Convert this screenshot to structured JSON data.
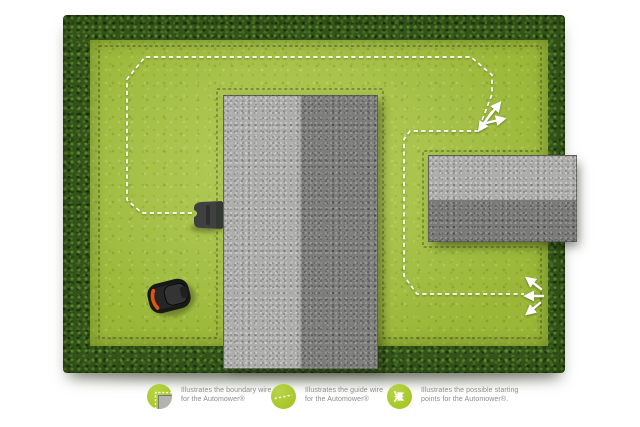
{
  "colors": {
    "background": "#ffffff",
    "grass_green": "#a5c240",
    "hedge_green": "#33531a",
    "legend_green": "#a4c422",
    "legend_text": "#8c8c8c",
    "building_gray": "#9c9c9a",
    "boundary_line": "#2e3524",
    "guide_line": "#ffffff",
    "charging_station": "#3f4140",
    "mower_body": "#181818",
    "mower_accent": "#e2560c"
  },
  "legend": {
    "items": [
      {
        "icon": "boundary-wire-icon",
        "line1": "Illustrates the boundary wire",
        "line2": "for the Automower®"
      },
      {
        "icon": "guide-wire-icon",
        "line1": "Illustrates the guide wire",
        "line2": "for the Automower®"
      },
      {
        "icon": "starting-points-icon",
        "line1": "Illustrates the possible starting",
        "line2": "points for the Automower®."
      }
    ]
  }
}
